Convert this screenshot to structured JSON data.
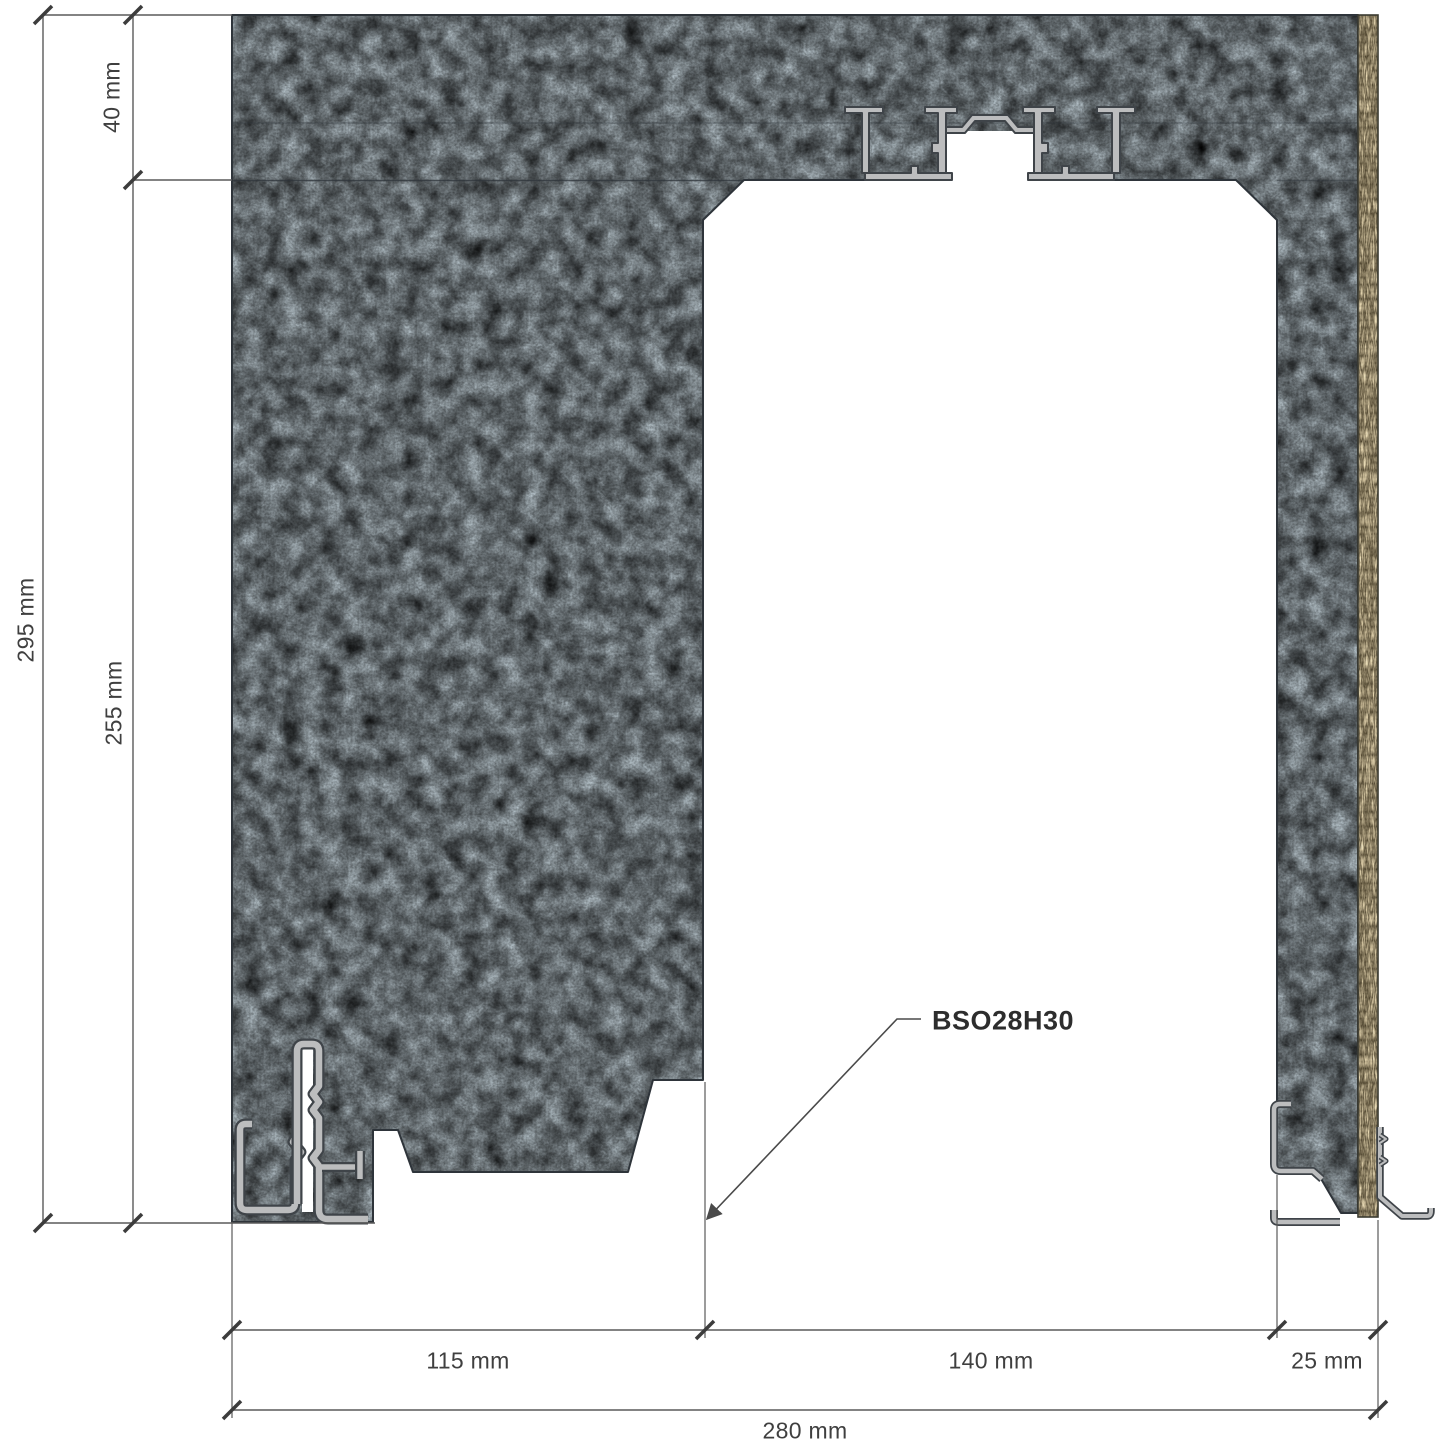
{
  "drawing": {
    "product_label": "BSO28H30",
    "dimensions": {
      "total_height": "295 mm",
      "lintel_height": "40 mm",
      "opening_height": "255 mm",
      "left_wall_width": "115 mm",
      "opening_width": "140 mm",
      "right_wall_width": "25 mm",
      "total_width": "280 mm"
    },
    "materials": {
      "wall_fill": "#5f6e78",
      "wood_board_fill": "#ddd2b6",
      "aluminum_fill": "#bcbdbe",
      "outline": "#2e343a",
      "dimension_color": "#555555",
      "text_color": "#3f3f3f"
    }
  }
}
